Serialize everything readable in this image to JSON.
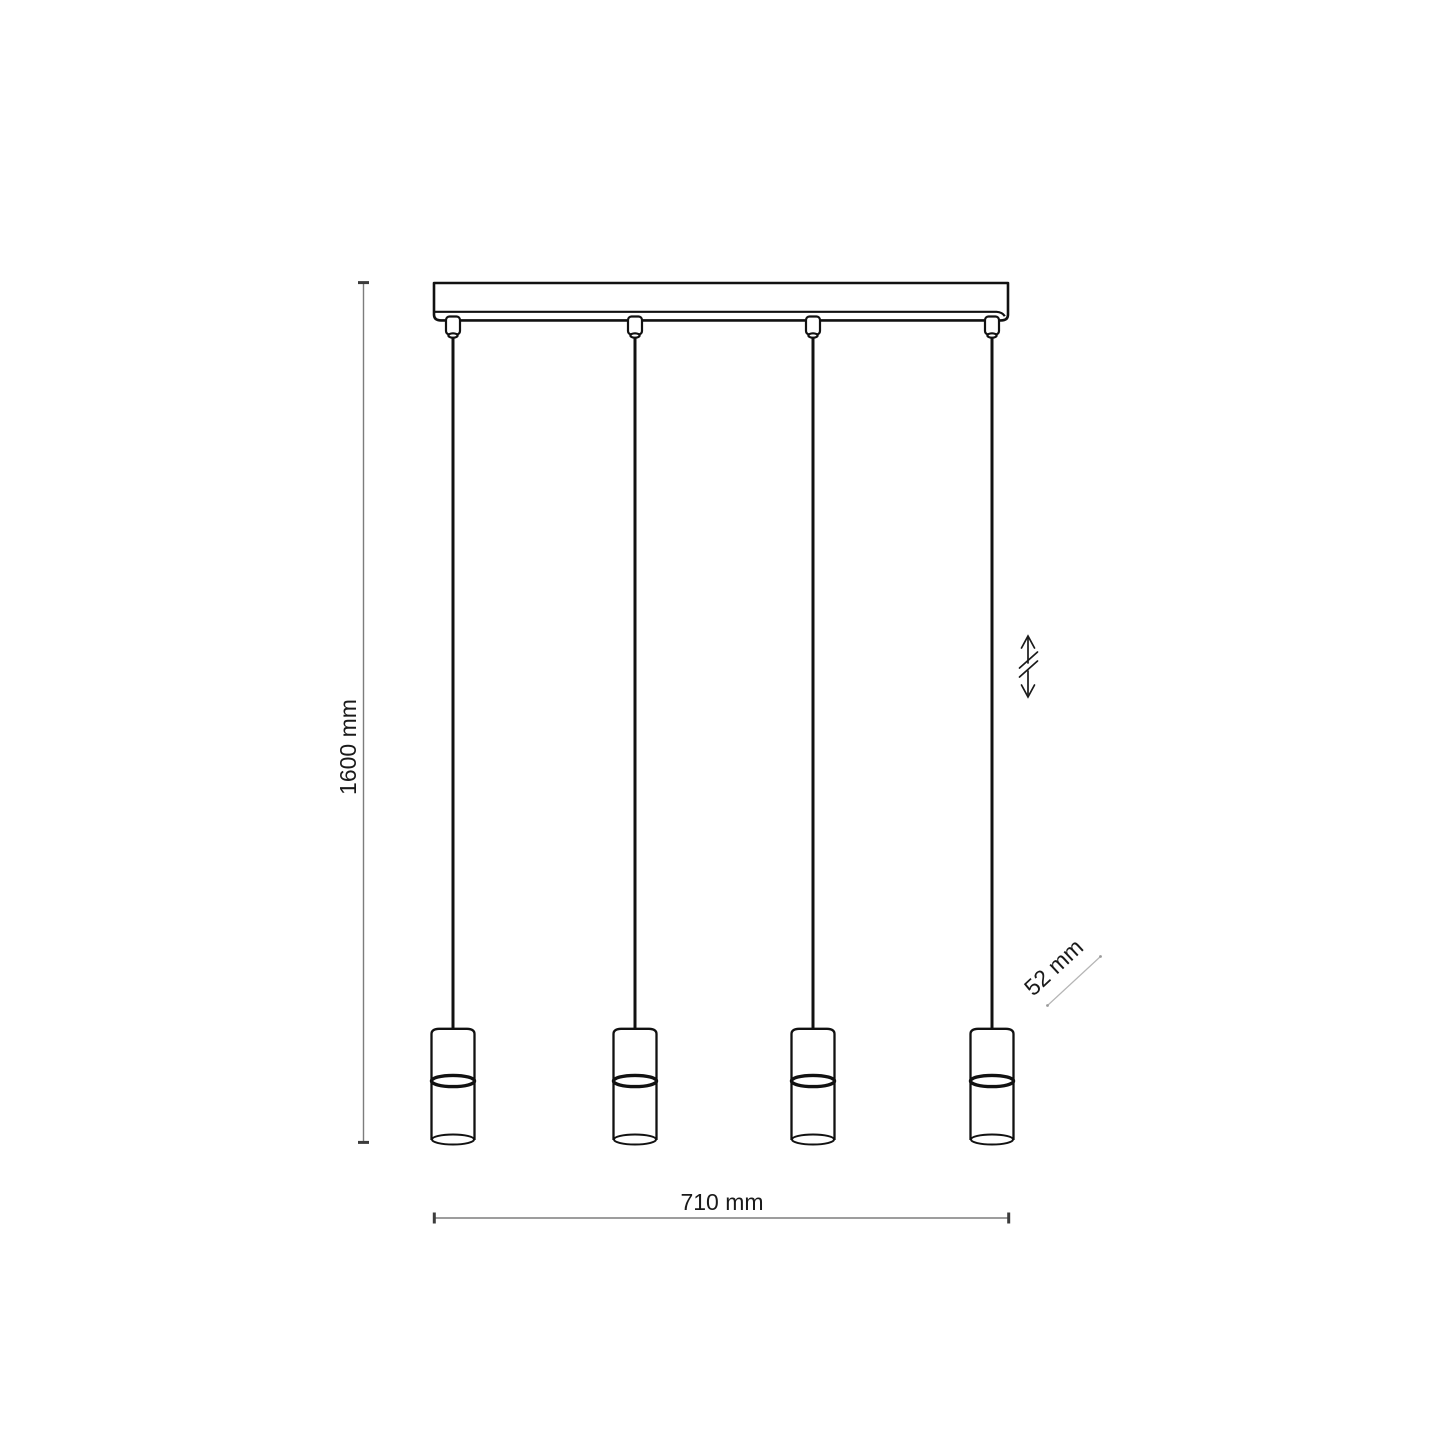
{
  "drawing": {
    "kind": "technical-dimension-diagram",
    "subject": "linear pendant lamp with four cylindrical shades on a ceiling bar",
    "pendant_count": 4,
    "dimensions": {
      "height_label": "1600 mm",
      "width_label": "710 mm",
      "shade_label": "52 mm"
    },
    "icons": {
      "height_adjust": "double-arrow-with-break-icon"
    },
    "colors": {
      "background": "#ffffff",
      "outline": "#111111",
      "dimension_line": "#7d7d7d",
      "dimension_cap": "#3c3c3c",
      "label_text": "#1a1a1a",
      "leader_line": "#b5b5b5"
    }
  }
}
